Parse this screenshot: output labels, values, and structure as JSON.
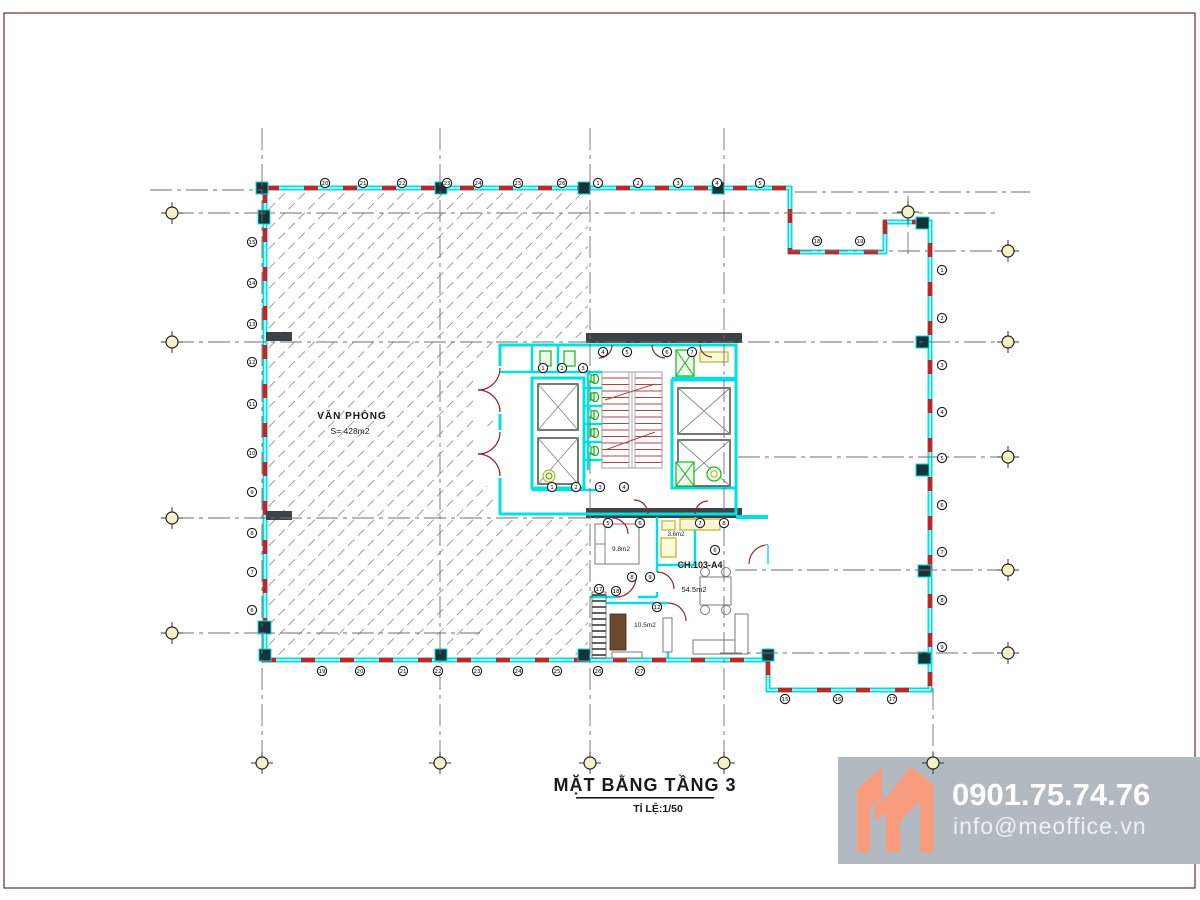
{
  "title_block": {
    "title": "MẶT BẰNG TẦNG 3",
    "scale_label": "TỈ LỆ:1/50"
  },
  "branding": {
    "phone": "0901.75.74.76",
    "email": "info@meoffice.vn",
    "logo": "meoffice-m-logo",
    "bg_color": "#b3b9c0",
    "logo_color": "#f89c7d",
    "text_color": "#ffffff"
  },
  "plan_labels": {
    "office_name": "VĂN PHÒNG",
    "office_area": "S= 428m2",
    "apartment_code": "CH.103-A4",
    "apartment_area": "54.5m2",
    "bedroom1_area": "9.8m2",
    "bathroom_area": "3.6m2",
    "bedroom2_area": "10.5m2"
  },
  "colors": {
    "wall": "#00e0e0",
    "window": "#c12626",
    "hatch": "#9aa0a4",
    "grid": "#6f6f6f",
    "bubble_fill": "#f2f2c6",
    "stairs": "#b24444",
    "fixtures": "#1fae1f",
    "dark_wall": "#3d4247",
    "counter": "#b8b126",
    "door_arc": "#8c2a2a",
    "frame_border": "#6b2b2b"
  },
  "grid": {
    "h_lines": [
      {
        "y": 190,
        "x1": 150,
        "x2": 263
      },
      {
        "y": 192,
        "x1": 795,
        "x2": 1030
      },
      {
        "y": 213,
        "x1": 172,
        "x2": 1000
      },
      {
        "y": 251,
        "x1": 790,
        "x2": 1008
      },
      {
        "y": 342,
        "x1": 172,
        "x2": 1008
      },
      {
        "y": 457,
        "x1": 738,
        "x2": 1008
      },
      {
        "y": 518,
        "x1": 172,
        "x2": 610
      },
      {
        "y": 570,
        "x1": 735,
        "x2": 1008
      },
      {
        "y": 633,
        "x1": 172,
        "x2": 480
      },
      {
        "y": 653,
        "x1": 720,
        "x2": 1008
      }
    ],
    "v_lines": [
      {
        "x": 262,
        "y1": 128,
        "y2": 763
      },
      {
        "x": 440,
        "y1": 128,
        "y2": 763
      },
      {
        "x": 590,
        "y1": 128,
        "y2": 763
      },
      {
        "x": 724,
        "y1": 128,
        "y2": 763
      },
      {
        "x": 908,
        "y1": 196,
        "y2": 258
      },
      {
        "x": 933,
        "y1": 688,
        "y2": 763
      }
    ],
    "bubbles": [
      {
        "x": 172,
        "y": 213
      },
      {
        "x": 172,
        "y": 342
      },
      {
        "x": 172,
        "y": 518
      },
      {
        "x": 172,
        "y": 633
      },
      {
        "x": 1008,
        "y": 251
      },
      {
        "x": 1008,
        "y": 342
      },
      {
        "x": 1008,
        "y": 457
      },
      {
        "x": 1008,
        "y": 570
      },
      {
        "x": 1008,
        "y": 653
      },
      {
        "x": 262,
        "y": 763
      },
      {
        "x": 440,
        "y": 763
      },
      {
        "x": 590,
        "y": 763
      },
      {
        "x": 724,
        "y": 763
      },
      {
        "x": 933,
        "y": 763
      },
      {
        "x": 908,
        "y": 212
      }
    ]
  },
  "opening_markers": [
    {
      "x": 325,
      "y": 183,
      "n": "20"
    },
    {
      "x": 363,
      "y": 183,
      "n": "21"
    },
    {
      "x": 402,
      "y": 183,
      "n": "22"
    },
    {
      "x": 447,
      "y": 183,
      "n": "23"
    },
    {
      "x": 478,
      "y": 183,
      "n": "24"
    },
    {
      "x": 518,
      "y": 183,
      "n": "25"
    },
    {
      "x": 562,
      "y": 183,
      "n": "26"
    },
    {
      "x": 598,
      "y": 183,
      "n": "1"
    },
    {
      "x": 638,
      "y": 183,
      "n": "2"
    },
    {
      "x": 678,
      "y": 183,
      "n": "3"
    },
    {
      "x": 717,
      "y": 183,
      "n": "4"
    },
    {
      "x": 760,
      "y": 183,
      "n": "5"
    },
    {
      "x": 817,
      "y": 241,
      "n": "18"
    },
    {
      "x": 860,
      "y": 241,
      "n": "19"
    },
    {
      "x": 942,
      "y": 270,
      "n": "1"
    },
    {
      "x": 942,
      "y": 318,
      "n": "2"
    },
    {
      "x": 942,
      "y": 365,
      "n": "3"
    },
    {
      "x": 942,
      "y": 412,
      "n": "4"
    },
    {
      "x": 942,
      "y": 458,
      "n": "5"
    },
    {
      "x": 942,
      "y": 505,
      "n": "6"
    },
    {
      "x": 942,
      "y": 552,
      "n": "7"
    },
    {
      "x": 942,
      "y": 600,
      "n": "8"
    },
    {
      "x": 942,
      "y": 647,
      "n": "9"
    },
    {
      "x": 252,
      "y": 242,
      "n": "15"
    },
    {
      "x": 252,
      "y": 283,
      "n": "14"
    },
    {
      "x": 252,
      "y": 324,
      "n": "13"
    },
    {
      "x": 252,
      "y": 362,
      "n": "12"
    },
    {
      "x": 252,
      "y": 404,
      "n": "11"
    },
    {
      "x": 252,
      "y": 453,
      "n": "10"
    },
    {
      "x": 252,
      "y": 492,
      "n": "9"
    },
    {
      "x": 252,
      "y": 533,
      "n": "8"
    },
    {
      "x": 252,
      "y": 572,
      "n": "7"
    },
    {
      "x": 252,
      "y": 610,
      "n": "6"
    },
    {
      "x": 322,
      "y": 671,
      "n": "19"
    },
    {
      "x": 360,
      "y": 671,
      "n": "20"
    },
    {
      "x": 403,
      "y": 671,
      "n": "21"
    },
    {
      "x": 438,
      "y": 671,
      "n": "22"
    },
    {
      "x": 477,
      "y": 671,
      "n": "23"
    },
    {
      "x": 518,
      "y": 671,
      "n": "24"
    },
    {
      "x": 557,
      "y": 671,
      "n": "25"
    },
    {
      "x": 598,
      "y": 671,
      "n": "26"
    },
    {
      "x": 640,
      "y": 671,
      "n": "27"
    },
    {
      "x": 785,
      "y": 699,
      "n": "15"
    },
    {
      "x": 838,
      "y": 699,
      "n": "16"
    },
    {
      "x": 892,
      "y": 699,
      "n": "17"
    },
    {
      "x": 543,
      "y": 368,
      "n": "1"
    },
    {
      "x": 562,
      "y": 368,
      "n": "2"
    },
    {
      "x": 583,
      "y": 368,
      "n": "3"
    },
    {
      "x": 603,
      "y": 352,
      "n": "4"
    },
    {
      "x": 627,
      "y": 352,
      "n": "5"
    },
    {
      "x": 667,
      "y": 352,
      "n": "6"
    },
    {
      "x": 692,
      "y": 352,
      "n": "7"
    },
    {
      "x": 552,
      "y": 487,
      "n": "1"
    },
    {
      "x": 576,
      "y": 487,
      "n": "2"
    },
    {
      "x": 600,
      "y": 487,
      "n": "3"
    },
    {
      "x": 624,
      "y": 487,
      "n": "4"
    },
    {
      "x": 608,
      "y": 523,
      "n": "5"
    },
    {
      "x": 640,
      "y": 523,
      "n": "6"
    },
    {
      "x": 700,
      "y": 523,
      "n": "7"
    },
    {
      "x": 724,
      "y": 523,
      "n": "8"
    },
    {
      "x": 632,
      "y": 577,
      "n": "8"
    },
    {
      "x": 650,
      "y": 577,
      "n": "9"
    },
    {
      "x": 657,
      "y": 607,
      "n": "12"
    },
    {
      "x": 715,
      "y": 550,
      "n": "6"
    },
    {
      "x": 599,
      "y": 589,
      "n": "17"
    },
    {
      "x": 616,
      "y": 591,
      "n": "18"
    }
  ]
}
